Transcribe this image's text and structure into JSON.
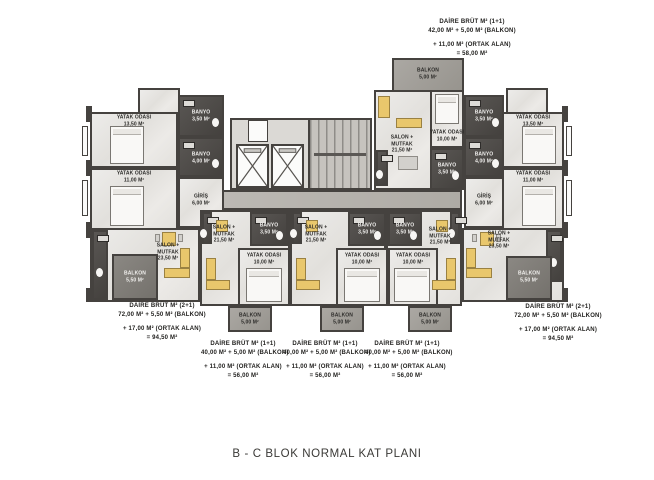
{
  "title": "B - C  BLOK NORMAL KAT PLANI",
  "colors": {
    "wall": "#45423f",
    "floor_light": "#e9e7e4",
    "wet_room_dark": "#4e4b48",
    "balcony_gray": "#9d9a95",
    "corridor": "#b6b3ae",
    "furniture_accent": "#e9c76c"
  },
  "annotations": {
    "top": {
      "line1": "DAİRE BRÜT M² (1+1)",
      "line2": "42,00 M² + 5,00 M² (BALKON)",
      "line3": "+ 11,00 M² (ORTAK ALAN)",
      "line4": "= 58,00 M²"
    },
    "bottom_left": {
      "line1": "DAİRE BRÜT M² (2+1)",
      "line2": "72,00 M² + 5,50 M² (BALKON)",
      "line3": "+ 17,00 M² (ORTAK ALAN)",
      "line4": "= 94,50 M²"
    },
    "mid1": {
      "line1": "DAİRE BRÜT M² (1+1)",
      "line2": "40,00 M² + 5,00 M² (BALKON)",
      "line3": "+ 11,00 M² (ORTAK ALAN)",
      "line4": "= 56,00 M²"
    },
    "mid2": {
      "line1": "DAİRE BRÜT M² (1+1)",
      "line2": "40,00 M² + 5,00 M² (BALKON)",
      "line3": "+ 11,00 M² (ORTAK ALAN)",
      "line4": "= 56,00 M²"
    },
    "mid3": {
      "line1": "DAİRE BRÜT M² (1+1)",
      "line2": "40,00 M² + 5,00 M² (BALKON)",
      "line3": "+ 11,00 M² (ORTAK ALAN)",
      "line4": "= 56,00 M²"
    },
    "bottom_right": {
      "line1": "DAİRE BRÜT M² (2+1)",
      "line2": "72,00 M² + 5,50 M² (BALKON)",
      "line3": "+ 17,00 M² (ORTAK ALAN)",
      "line4": "= 94,50 M²"
    }
  },
  "plan": {
    "left_wing": {
      "bed1": {
        "name": "YATAK ODASI",
        "area": "13,50 M²"
      },
      "bed2": {
        "name": "YATAK ODASI",
        "area": "11,00 M²"
      },
      "bath1": {
        "name": "BANYO",
        "area": "3,50 M²"
      },
      "bath2": {
        "name": "BANYO",
        "area": "4,00 M²"
      },
      "entry": {
        "name": "GİRİŞ",
        "area": "6,00 M²"
      },
      "salon": {
        "name": "SALON +",
        "name2": "MUTFAK",
        "area": "23,50 M²"
      },
      "balcony": {
        "name": "BALKON",
        "area": "5,50 M²"
      }
    },
    "right_wing": {
      "bed1": {
        "name": "YATAK ODASI",
        "area": "13,50 M²"
      },
      "bed2": {
        "name": "YATAK ODASI",
        "area": "11,00 M²"
      },
      "bath1": {
        "name": "BANYO",
        "area": "3,50 M²"
      },
      "bath2": {
        "name": "BANYO",
        "area": "4,00 M²"
      },
      "entry": {
        "name": "GİRİŞ",
        "area": "6,00 M²"
      },
      "salon": {
        "name": "SALON +",
        "name2": "MUTFAK",
        "area": "23,50 M²"
      },
      "balcony": {
        "name": "BALKON",
        "area": "5,50 M²"
      }
    },
    "top_unit": {
      "salon": {
        "name": "SALON +",
        "name2": "MUTFAK",
        "area": "21,50 M²"
      },
      "bed": {
        "name": "YATAK ODASI",
        "area": "10,00 M²"
      },
      "bath": {
        "name": "BANYO",
        "area": "3,50 M²"
      },
      "balcony": {
        "name": "BALKON",
        "area": "5,00 M²"
      }
    },
    "unit1": {
      "salon": {
        "name": "SALON +",
        "name2": "MUTFAK",
        "area": "21,50 M²"
      },
      "bed": {
        "name": "YATAK ODASI",
        "area": "10,00 M²"
      },
      "bath": {
        "name": "BANYO",
        "area": "3,50 M²"
      },
      "balcony": {
        "name": "BALKON",
        "area": "5,00 M²"
      }
    },
    "unit2": {
      "salon": {
        "name": "SALON +",
        "name2": "MUTFAK",
        "area": "21,50 M²"
      },
      "bed": {
        "name": "YATAK ODASI",
        "area": "10,00 M²"
      },
      "bath": {
        "name": "BANYO",
        "area": "3,50 M²"
      },
      "balcony": {
        "name": "BALKON",
        "area": "5,00 M²"
      }
    },
    "unit3": {
      "salon": {
        "name": "SALON +",
        "name2": "MUTFAK",
        "area": "21,50 M²"
      },
      "bed": {
        "name": "YATAK ODASI",
        "area": "10,00 M²"
      },
      "bath": {
        "name": "BANYO",
        "area": "3,50 M²"
      },
      "balcony": {
        "name": "BALKON",
        "area": "5,00 M²"
      }
    }
  }
}
